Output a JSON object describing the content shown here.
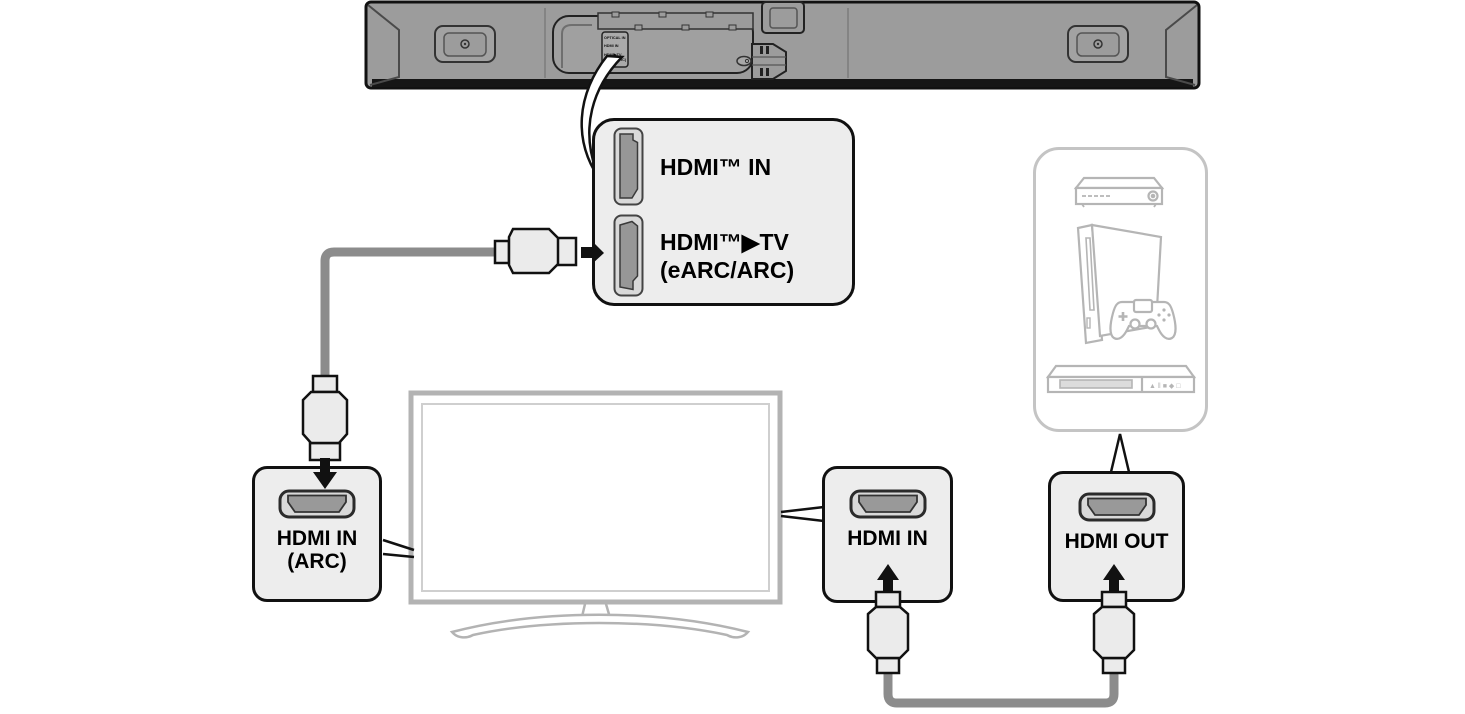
{
  "colors": {
    "outline": "#111111",
    "soundbar_body": "#9c9c9c",
    "callout_fill": "#ededed",
    "port_dark": "#999999",
    "port_light": "#d9d9d9",
    "cable": "#8c8c8c",
    "plug_fill": "#ebebeb",
    "tv_outline": "#b3b3b3",
    "device_art": "#b5b5b5"
  },
  "soundbar": {
    "panel_labels": [
      "OPTICAL IN",
      "HDMI IN",
      "HDMI▶TV",
      "(eARC/ARC)"
    ]
  },
  "callout": {
    "port1_label": "HDMI™ IN",
    "port2_label_line1": "HDMI™▶TV",
    "port2_label_line2": "(eARC/ARC)"
  },
  "tv_box": {
    "line1": "HDMI IN",
    "line2": "(ARC)"
  },
  "in_box": {
    "label": "HDMI IN"
  },
  "out_box": {
    "label": "HDMI OUT"
  },
  "disc_player": {
    "buttons": "▲ ‖ ■ ◆ □"
  }
}
